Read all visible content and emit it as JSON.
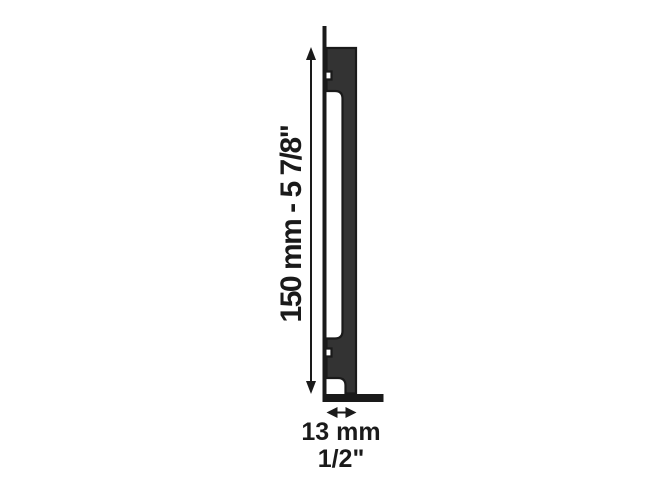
{
  "labels": {
    "height_dimension": "150 mm - 5 7/8\"",
    "depth_dimension_mm": "13 mm",
    "depth_dimension_in": "1/2\""
  },
  "colors": {
    "background": "#ffffff",
    "bracket_fill": "#333333",
    "outline": "#1a1a1a",
    "text": "#1a1a1a"
  }
}
